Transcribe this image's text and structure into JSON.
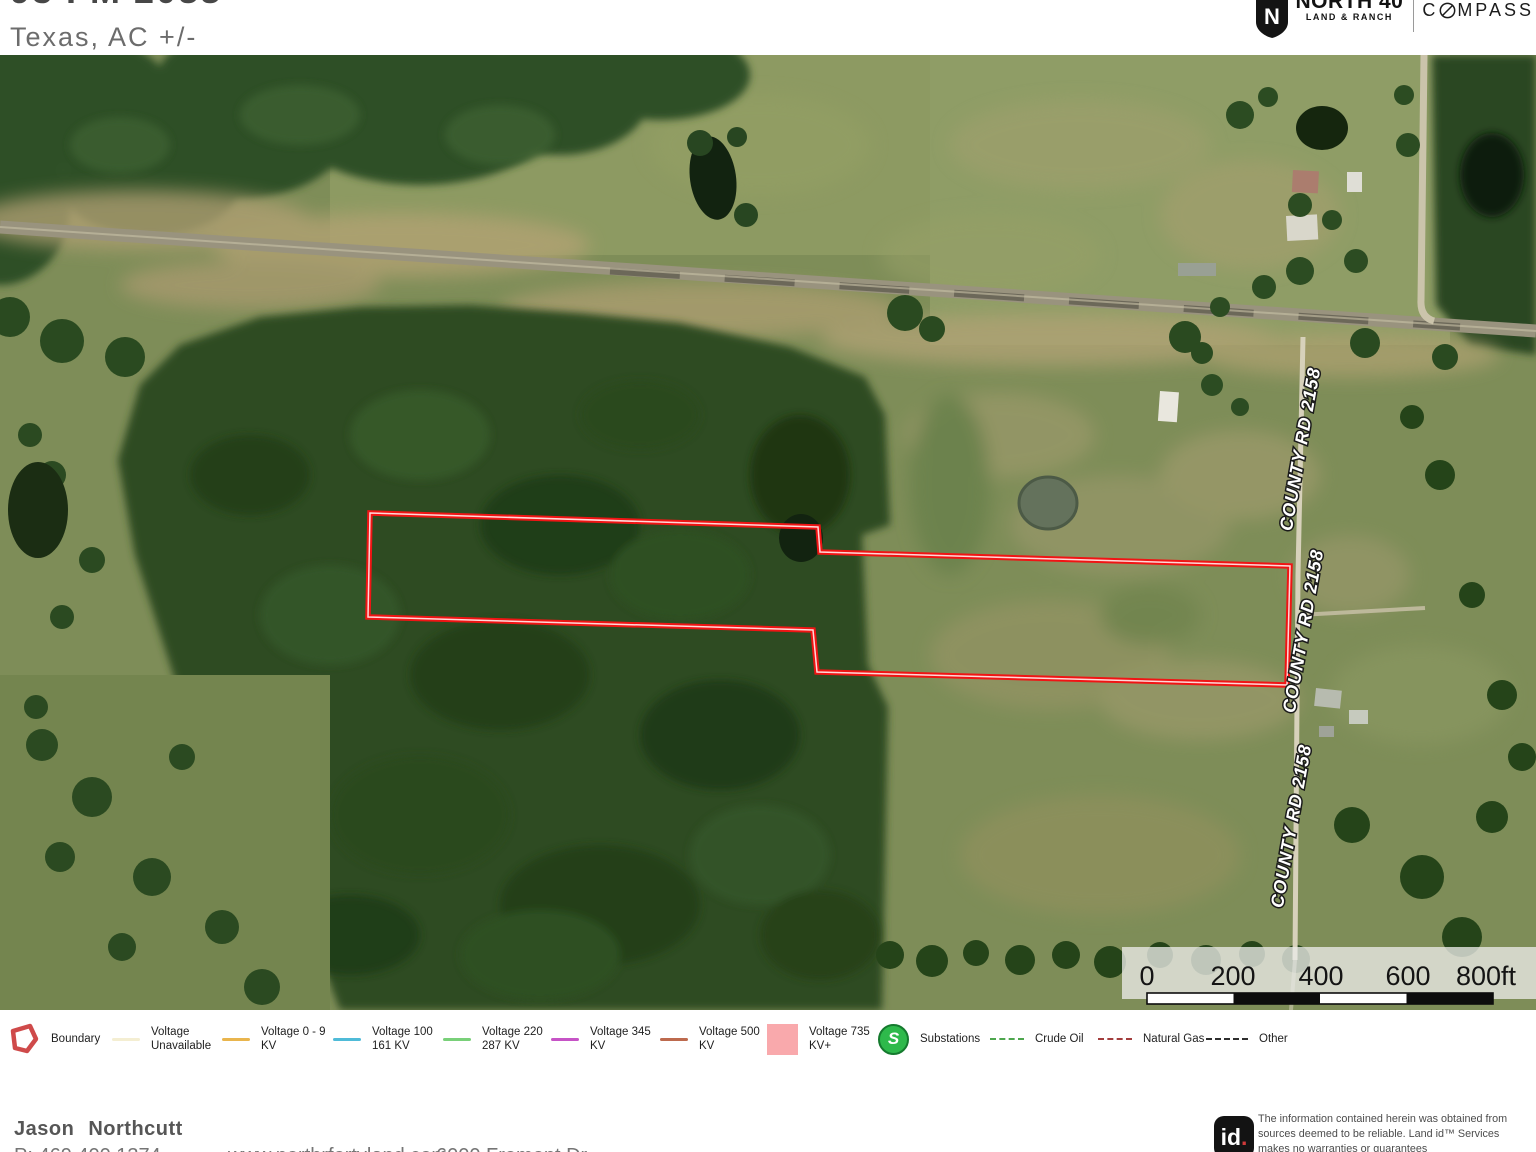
{
  "header": {
    "title_line1": "93 FM 2088",
    "title_line2": "Texas,  AC +/-",
    "brand": {
      "shield_letter": "N",
      "name_top": "NORTH 40",
      "name_bottom": "LAND & RANCH",
      "partner_prefix": "C",
      "partner_suffix": "MPASS"
    }
  },
  "map": {
    "road_labels": [
      {
        "text": "COUNTY RD 2158"
      },
      {
        "text": "COUNTY RD 2158"
      },
      {
        "text": "COUNTY RD 2158"
      }
    ],
    "scale_bar": {
      "ticks": [
        "0",
        "200",
        "400",
        "600",
        "800ft"
      ]
    },
    "boundary_color": "#f01414"
  },
  "legend": {
    "items": [
      {
        "label": "Boundary",
        "type": "boundary",
        "color": "#cf4a4a"
      },
      {
        "label": "Voltage Unavailable",
        "type": "line",
        "color": "#f4eed2"
      },
      {
        "label": "Voltage 0 - 9 KV",
        "type": "line",
        "color": "#e9b54d"
      },
      {
        "label": "Voltage 100 161 KV",
        "type": "line",
        "color": "#4fbbd8"
      },
      {
        "label": "Voltage 220 287 KV",
        "type": "line",
        "color": "#79d079"
      },
      {
        "label": "Voltage 345 KV",
        "type": "line",
        "color": "#c653c6"
      },
      {
        "label": "Voltage 500 KV",
        "type": "line",
        "color": "#bd6a4e"
      },
      {
        "label": "Voltage 735 KV+",
        "type": "square",
        "color": "#f9a9ac"
      },
      {
        "label": "Substations",
        "type": "substation",
        "color": "#2eb94b",
        "letter": "S"
      },
      {
        "label": "Crude Oil",
        "type": "dashed",
        "color": "#4da64d"
      },
      {
        "label": "Natural Gas",
        "type": "dashed",
        "color": "#a33d3d"
      },
      {
        "label": "Other",
        "type": "dashed",
        "color": "#2e2e2e"
      }
    ]
  },
  "footer": {
    "agent_name": "Jason Northcutt",
    "phone": "P: 469.400.1374",
    "website": "www.northrfortyland.com",
    "address": "6000 Fremont Dr",
    "id_mark": "id",
    "id_dot": ".",
    "disclaimer": "The information contained herein was obtained from sources deemed to be reliable.  Land id™  Services makes no warranties or guarantees"
  }
}
